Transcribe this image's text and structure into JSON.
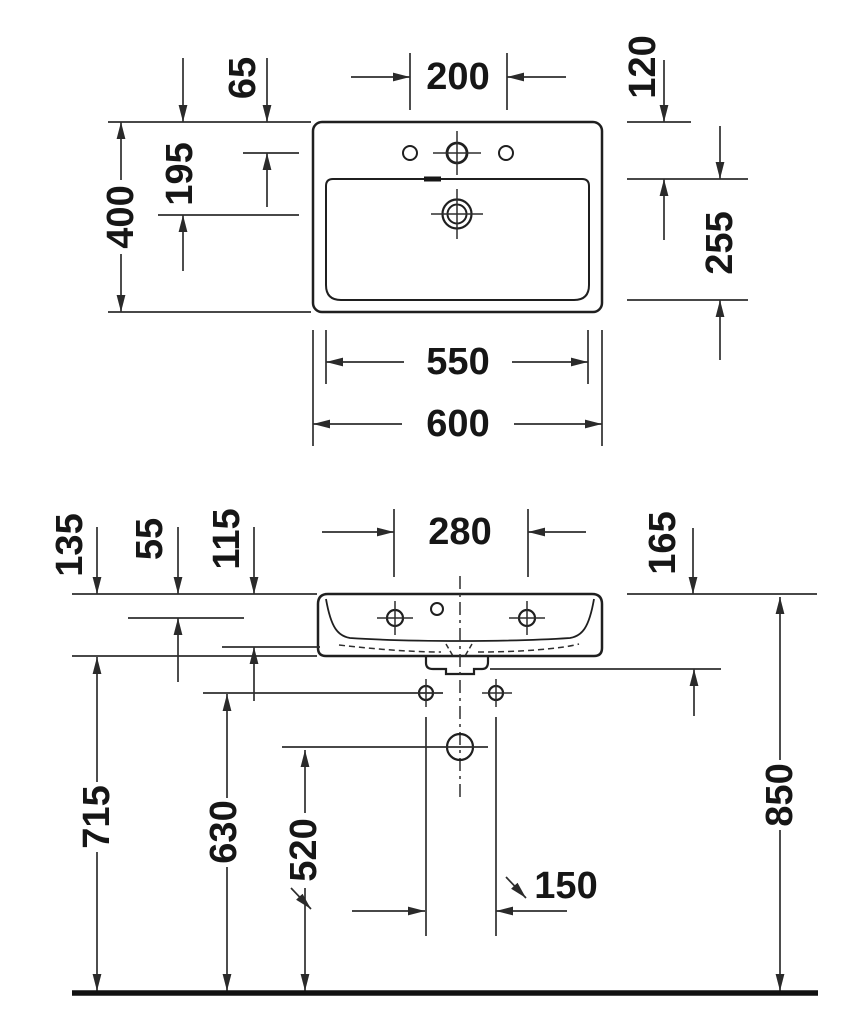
{
  "drawing": {
    "type": "technical-dimension-drawing",
    "subject": "wall-mounted washbasin, plan view and front elevation",
    "units": "mm",
    "line_color": "#1f1f1f",
    "background": "#ffffff"
  },
  "top_view": {
    "tap_hole_spacing": "200",
    "rim_to_tap_hole_line": "65",
    "rim_to_basin_front_edge": "120",
    "rim_to_drain_center": "195",
    "overall_depth": "400",
    "basin_inner_depth": "255",
    "basin_inner_width": "550",
    "overall_width": "600"
  },
  "front_view": {
    "fixing_hole_spacing": "280",
    "rim_to_tap_hole_line": "55",
    "rim_to_basin_inner_bottom": "115",
    "body_height": "135",
    "rim_to_outlet_bottom": "165",
    "floor_to_body_bottom": "715",
    "floor_to_wall_bolts": "630",
    "floor_to_drain_center": "520",
    "wall_bolt_spacing": "150",
    "floor_to_rim": "850"
  }
}
